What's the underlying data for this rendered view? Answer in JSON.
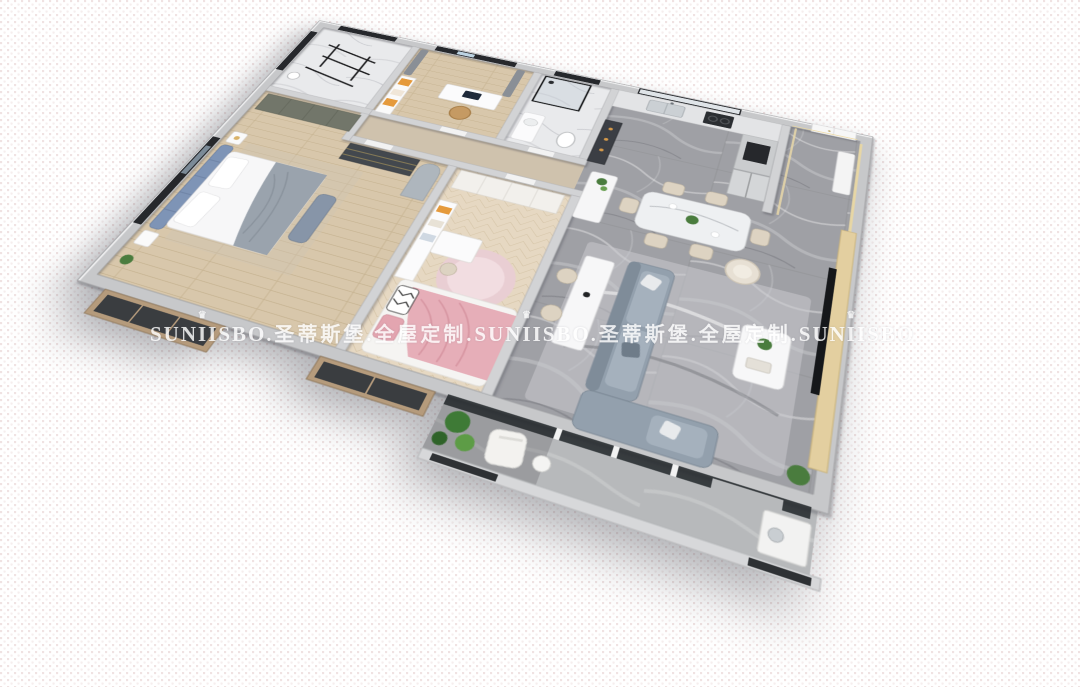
{
  "image": {
    "type": "3d-floorplan-render",
    "description": "Top-down isometric 3D dollhouse rendering of a three-bedroom apartment with open kitchen, dining and living area, long balcony and two bay windows",
    "view": "rotated top-down perspective"
  },
  "watermark": {
    "brand": "SUNIISBO",
    "brand_cn": "圣蒂斯堡",
    "tagline_cn": "全屋定制",
    "crown_icon": "♛",
    "color": "#ffffff",
    "segments": [
      "SUNIISBO",
      ".圣蒂斯堡.全屋定制.",
      "SUNIISBO",
      ".圣蒂斯堡.全屋定制.",
      "SUNIISBO"
    ]
  },
  "palette": {
    "background": "#ffffff",
    "dot": "#d6b2b2",
    "wall": "#c7c8ca",
    "wall-inner": "#d2d3d5",
    "floor-wood": "#d8c7ab",
    "floor-herringbone": "#e6d8c2",
    "floor-marble-gray": "#9fa0a5",
    "floor-marble-white": "#e9eaec",
    "floor-concrete": "#b7b9bb",
    "sofa-gray": "#93a0ad",
    "headboard-blue": "#7e94b6",
    "blanket-pink": "#e6aeb8",
    "rug-pink": "#e9ced3",
    "chair-beige": "#ddd3c2",
    "accent-orange": "#e59a3c",
    "tv-wall-gold": "#e3cfa0",
    "plant-green": "#4a7c3e",
    "frame-black": "#26282c",
    "watermark": "#ffffff"
  },
  "scene": {
    "rooms": [
      {
        "id": "laundry-room",
        "label": "laundry utility room",
        "features": [
          "black drying rack",
          "white marble floor",
          "window"
        ]
      },
      {
        "id": "study-room",
        "label": "study bedroom",
        "features": [
          "desk with monitor",
          "orange bookshelf",
          "window with gray curtains",
          "tan chair"
        ]
      },
      {
        "id": "bathroom",
        "label": "bathroom",
        "features": [
          "black-framed glass shower",
          "vanity",
          "toilet"
        ]
      },
      {
        "id": "kitchen",
        "label": "kitchen",
        "features": [
          "window",
          "double sink counter",
          "oven tower",
          "gray double-door fridge",
          "dark display cabinet"
        ]
      },
      {
        "id": "entry-foyer",
        "label": "entry foyer",
        "features": [
          "white entrance door",
          "shoe cabinet",
          "gold trim wall"
        ]
      },
      {
        "id": "hallway",
        "label": "hallway",
        "features": [
          "white storage cabinets"
        ]
      },
      {
        "id": "master-bedroom",
        "label": "master bedroom",
        "features": [
          "blue tufted headboard bed",
          "gray throw blanket",
          "dark wardrobe",
          "arched gray niche",
          "bay window"
        ]
      },
      {
        "id": "kids-bedroom",
        "label": "kids bedroom",
        "features": [
          "pink blanket bed",
          "round pink rug",
          "white shelf and desk",
          "wardrobe",
          "bay window"
        ]
      },
      {
        "id": "dining-area",
        "label": "dining area",
        "features": [
          "marble dining table",
          "six beige chairs",
          "white island with plant",
          "flower centerpiece"
        ]
      },
      {
        "id": "living-room",
        "label": "living room",
        "features": [
          "L-shaped gray sofa",
          "white coffee table with plant",
          "cream swivel chair",
          "console table with two chairs",
          "gold marble TV wall with dark TV"
        ]
      },
      {
        "id": "balcony",
        "label": "balcony",
        "features": [
          "green plants",
          "white lounge chair",
          "round side table",
          "white cabinet",
          "black-framed glass doors"
        ]
      }
    ]
  }
}
